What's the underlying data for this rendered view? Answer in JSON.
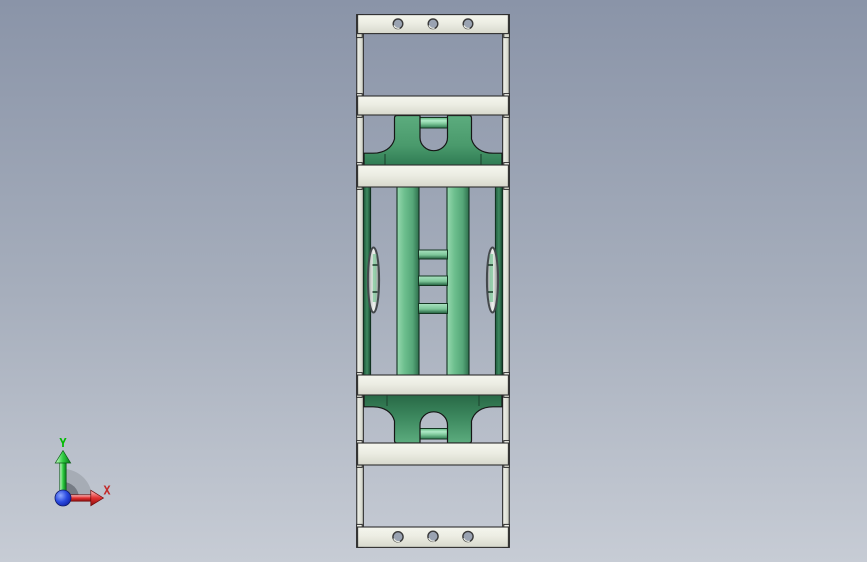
{
  "app": {
    "type": "cad-shaded-viewport",
    "title": ""
  },
  "viewport": {
    "background_top": "#8A94A8",
    "background_mid": "#A6AEBC",
    "background_bottom": "#C7CCD5"
  },
  "triad": {
    "y_label": "Y",
    "x_label": "X",
    "y_color": "#00BB00",
    "x_color": "#C22A2A",
    "origin_sphere_color": "#1B34C4",
    "plane_sector_color": "#A2A8B0"
  },
  "model": {
    "name": "track chain link assembly - front orthographic view",
    "parts": {
      "side_rails": 2,
      "crossbars": 4,
      "end_plates_with_holes": 2,
      "holes_per_plate": 3,
      "green_brackets": 2,
      "green_guide_bars": 2,
      "green_columns": 2,
      "ladder_rungs": 3,
      "side_rollers": 2
    },
    "colors": {
      "plate_white": "#ECEDE3",
      "rail_white": "#E2E4DB",
      "edge_outline": "#2E2E2E",
      "green_body": "#4A9A6C",
      "green_dark": "#2E7450",
      "green_light": "#8ED4A8",
      "roller_silver": "#E9EBE8",
      "hole_fill": "#9AA3B2"
    }
  }
}
